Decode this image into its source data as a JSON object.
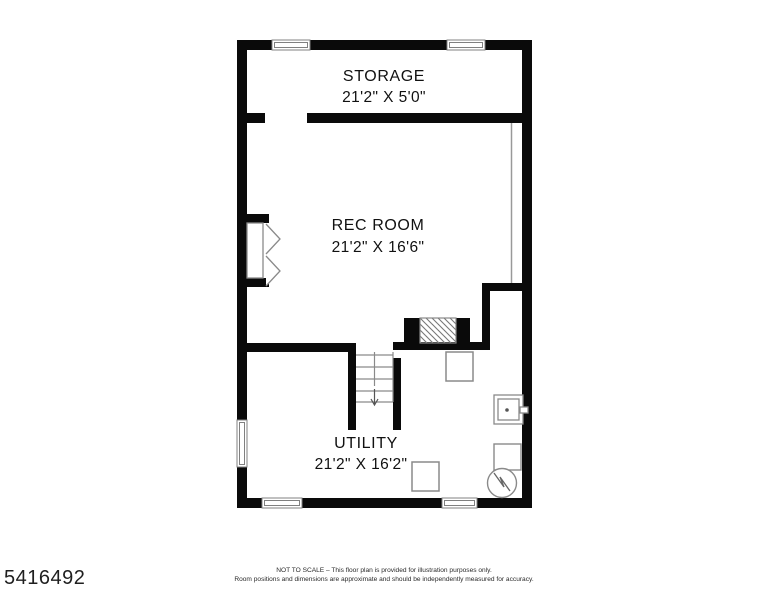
{
  "page": {
    "listing_id": "5416492",
    "disclaimer_line1": "NOT TO SCALE – This floor plan is provided for illustration purposes only.",
    "disclaimer_line2": "Room positions and dimensions are approximate and should be independently measured for accuracy."
  },
  "rooms": {
    "storage": {
      "name": "STORAGE",
      "dimensions": "21'2\" X 5'0\""
    },
    "rec_room": {
      "name": "REC ROOM",
      "dimensions": "21'2\" X 16'6\""
    },
    "utility": {
      "name": "UTILITY",
      "dimensions": "21'2\" X 16'2\""
    }
  },
  "colors": {
    "wall": "#0a0a0a",
    "fixture_line": "#8a8a8a",
    "text": "#111111"
  },
  "fixtures": [
    "double-door",
    "stairs-down",
    "fireplace",
    "support-post",
    "utility-sink",
    "furnace",
    "water-heater",
    "window"
  ]
}
